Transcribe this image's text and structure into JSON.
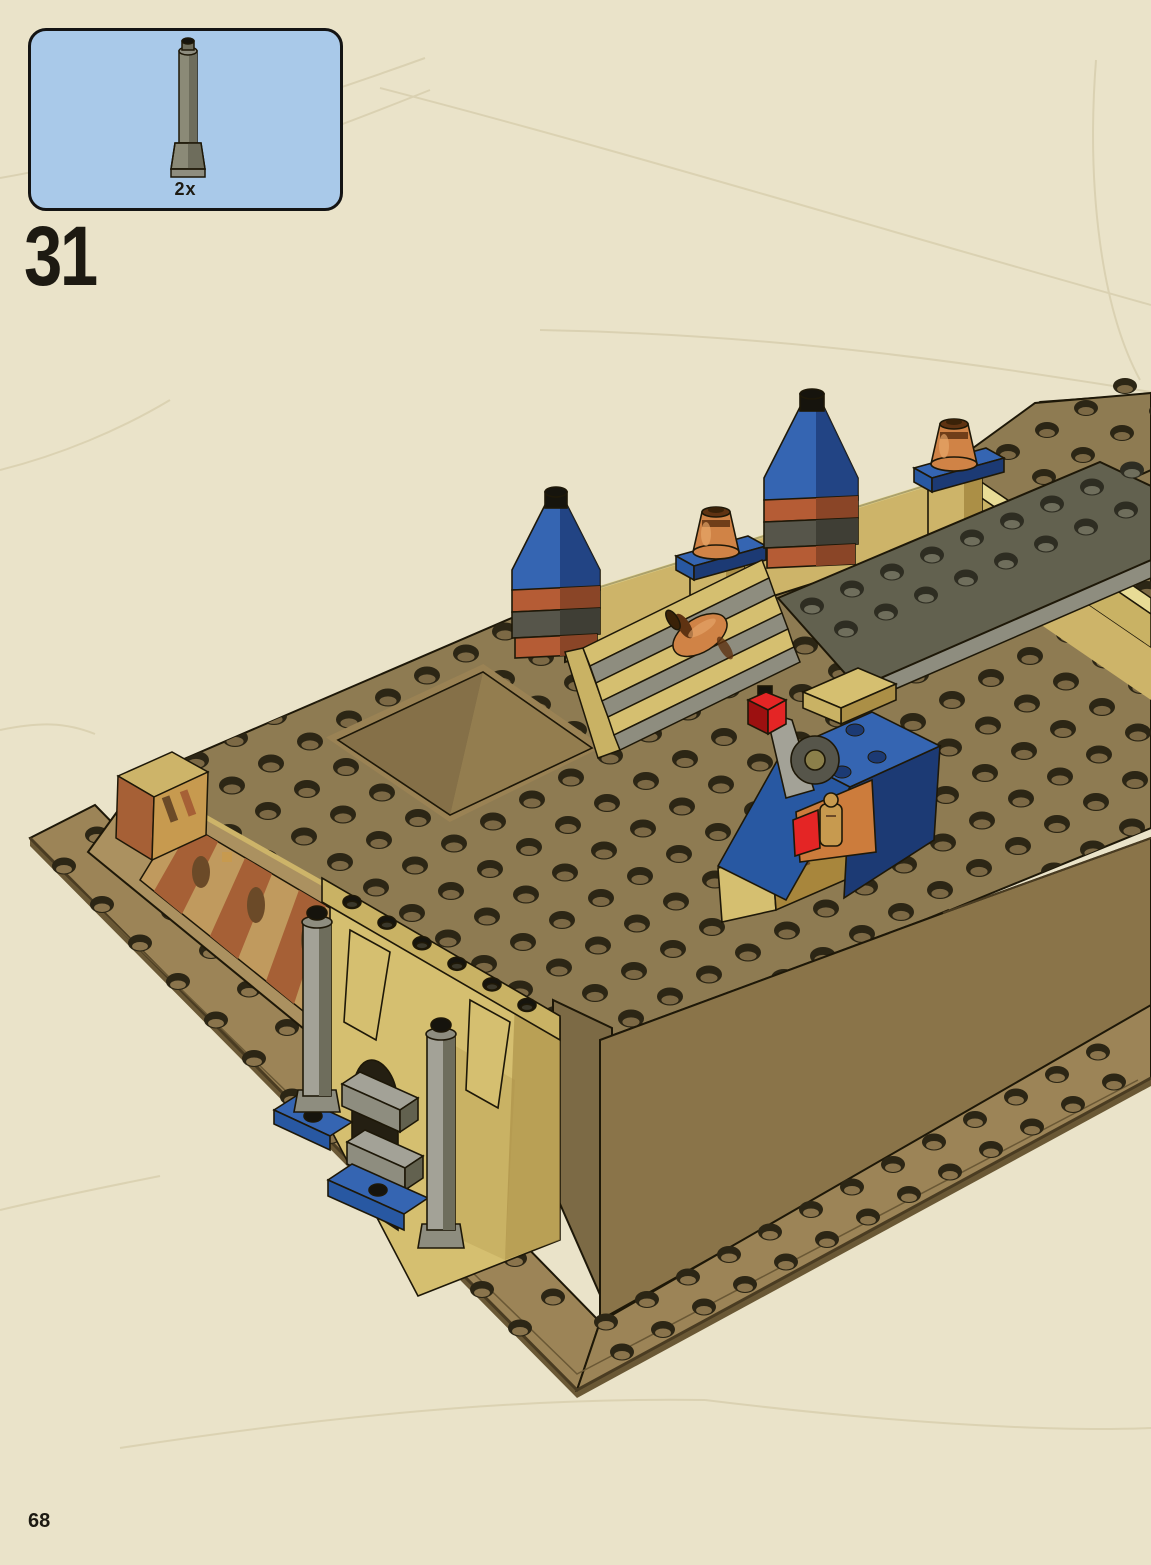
{
  "page": {
    "step_number": "31",
    "page_number": "68"
  },
  "parts_callout": {
    "quantity": "2x",
    "part": "grey-support-pillar"
  },
  "palette": {
    "paper": "#EAE3C9",
    "wrinkle": "#D8CFAE",
    "callout_bg": "#A9C9E9",
    "callout_border": "#141414",
    "ink": "#1D1A12",
    "line": "#1E1808",
    "plat": "#8E7B52",
    "stud_dark": "#2C2615",
    "stud_lite": "#7C6945",
    "band_stud_lite": "#8A744C",
    "base_band": "#9C8457",
    "base_line": "#4A3C22",
    "base_edge": "#6A5835",
    "wall_right": "#8A7449",
    "wall_dark": "#7C6A45",
    "tan_lite": "#D5BF70",
    "tan_mid": "#C9B264",
    "tan_dark": "#AB8F46",
    "tan_wall": "#CDB469",
    "groove_lite": "#E8DC96",
    "grey_lite": "#A3A297",
    "grey_mid": "#8E8D7F",
    "grey_dark": "#62614F",
    "grey_deep": "#3A382A",
    "walk_stud_dark": "#2E2D22",
    "walk_stud_lite": "#6F6E5C",
    "blue_lite": "#3565B2",
    "blue": "#2858A2",
    "blue_dark": "#1C3A74",
    "obelisk_grey": "#56554A",
    "obelisk_grey_dark": "#3F3E35",
    "stripe_orange": "#B55C35",
    "stripe_orange_dark": "#8A4527",
    "urn": "#D08346",
    "urn_dark": "#5F3312",
    "urn_hi": "#E8A96C",
    "urn_mouth": "#3A2208",
    "red": "#E42525",
    "red_dark": "#9C1010",
    "gold": "#A8863C",
    "gold_lite": "#C79A4F",
    "mech_gold": "#8B7F4A",
    "glyph_rust": "#A66036",
    "glyph_dark": "#6B4A28",
    "glyph_bg": "#C09A5E",
    "wall_frame": "#AB9160",
    "black_piece": "#16140D",
    "beam_stud_lite": "#3A372A",
    "piece_grey": "#8B8A77",
    "piece_grey_dark": "#6E6D5C",
    "pit": "#6E5C3A",
    "pit_lite": "#9A8254",
    "pit_mid": "#857048",
    "arch_dark": "#241F12",
    "shrine_orange": "#CC7C3C"
  }
}
